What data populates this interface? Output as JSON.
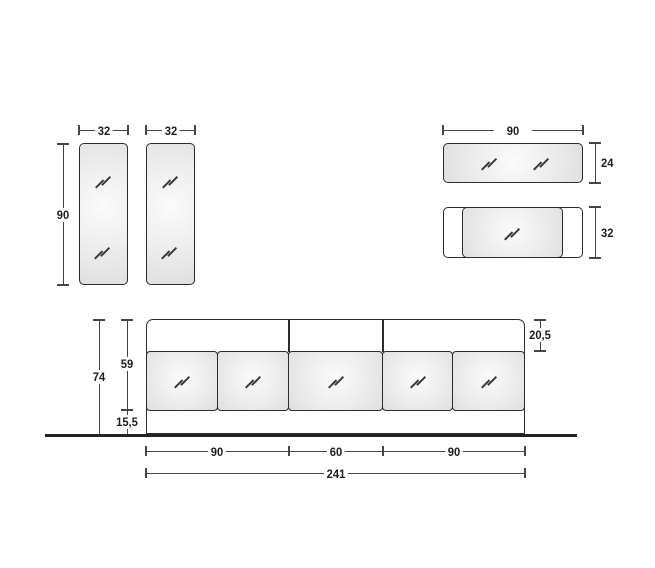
{
  "colors": {
    "dimension_line": "#454545",
    "object_border": "#2c2c2c",
    "label_text": "#1c1c1c",
    "floor_line": "#232323",
    "glass_fill": "#e7e7e7"
  },
  "groups": {
    "tall_mirrors": {
      "width_left": "32",
      "width_right": "32",
      "height": "90"
    },
    "wide_units": {
      "width": "90",
      "mirror_height": "24",
      "cabinet_height": "32"
    },
    "composition": {
      "total_height": "74",
      "upper_height": "59",
      "plinth_height": "15,5",
      "top_inset": "20,5",
      "module_widths": [
        "90",
        "60",
        "90"
      ],
      "total_width": "241"
    }
  }
}
